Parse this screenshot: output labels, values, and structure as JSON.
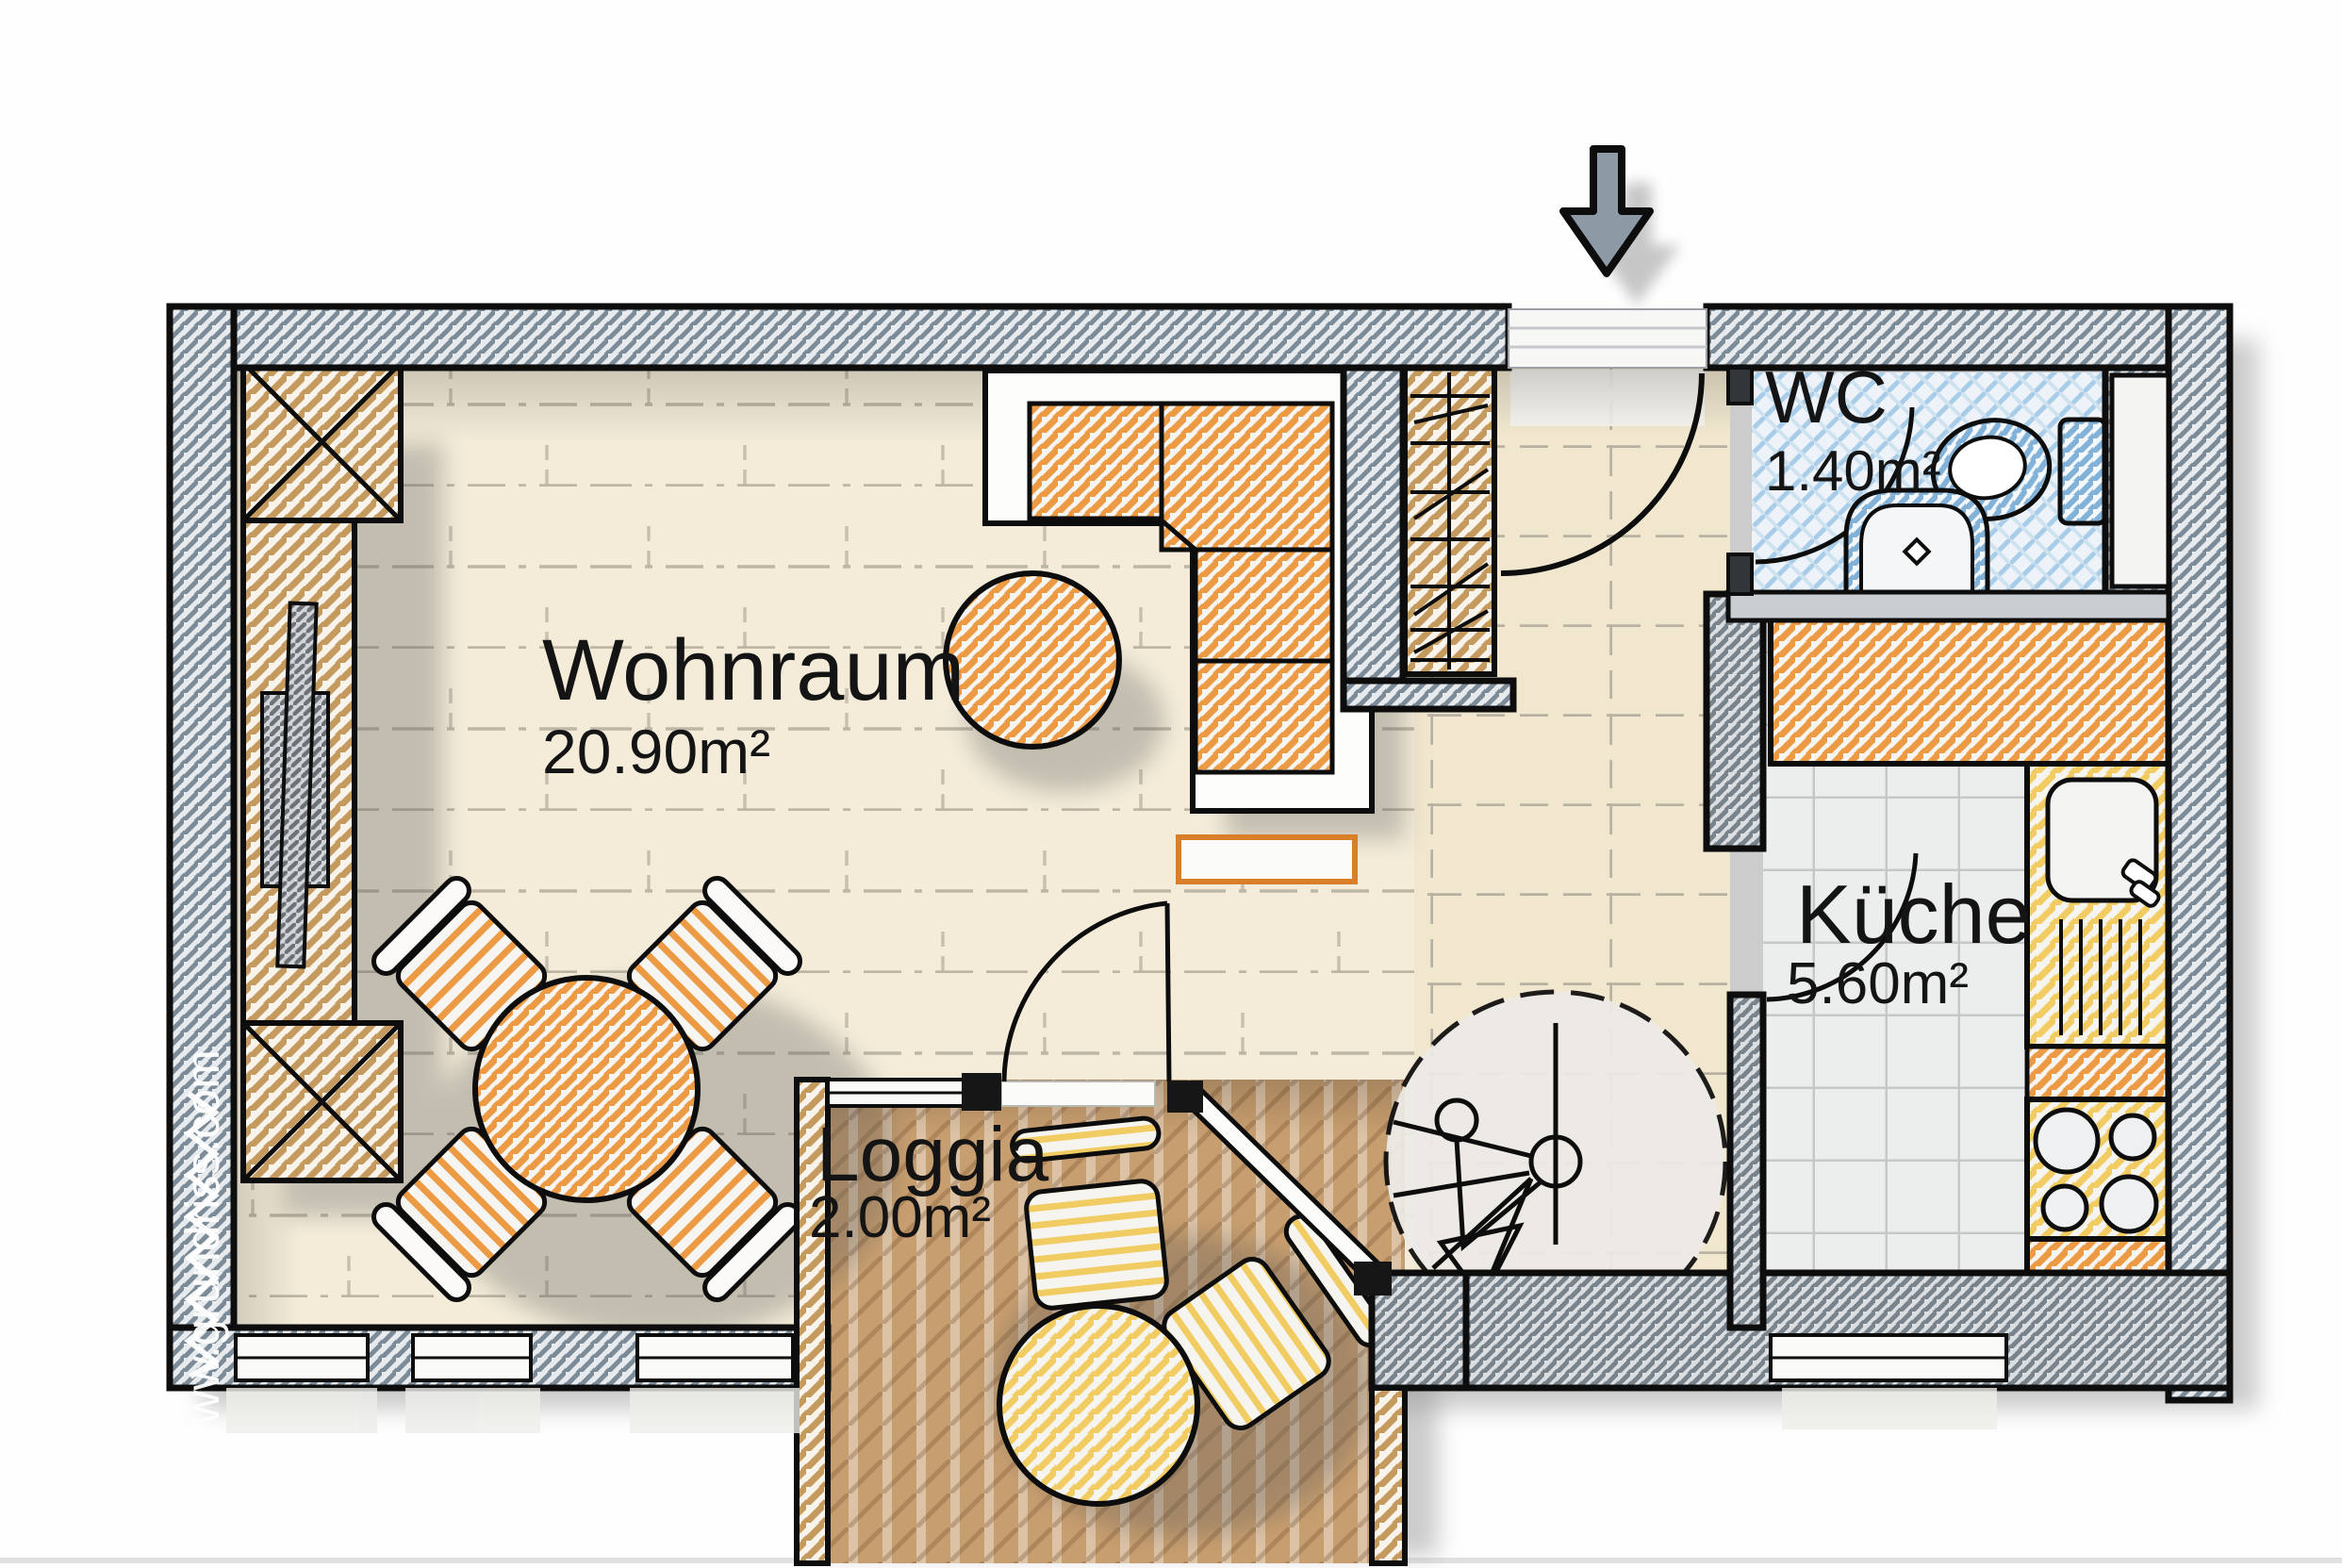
{
  "watermark": "www.grundriss.com",
  "rooms": [
    {
      "id": "wohnraum",
      "name": "Wohnraum",
      "area": "20.90m²"
    },
    {
      "id": "wc",
      "name": "WC",
      "area": "1.40m²"
    },
    {
      "id": "kueche",
      "name": "Küche",
      "area": "5.60m²"
    },
    {
      "id": "loggia",
      "name": "Loggia",
      "area": "2.00m²"
    }
  ],
  "colors": {
    "wall_hatch": "#7b8b98",
    "wall_hatch_dark": "#79838c",
    "wood_tan": "#c59a5e",
    "furniture_orange": "#ec9a43",
    "furniture_yellow": "#f1cc62",
    "bath_blue": "#a9cde8",
    "fixture_blue": "#82b2d8",
    "arrow_gray": "#8d9aa6",
    "floor_living": "#f4ecd9",
    "floor_hall": "#f1e7cf",
    "floor_kitchen": "#eceded",
    "deck_brown": "#c79e6f"
  }
}
